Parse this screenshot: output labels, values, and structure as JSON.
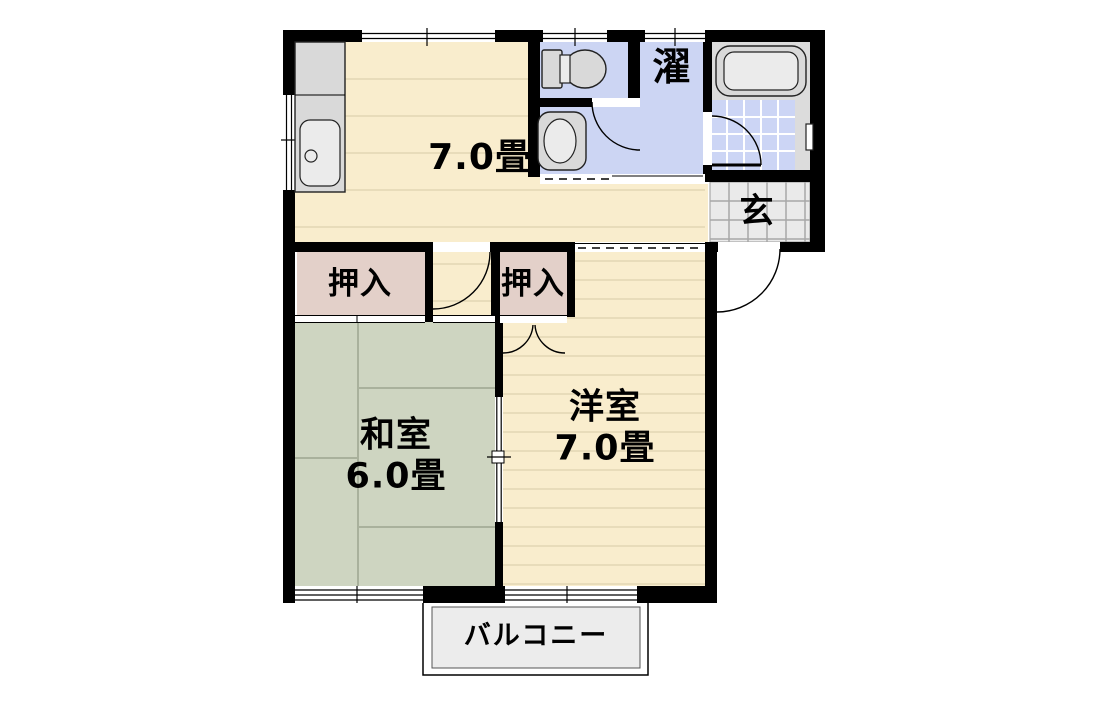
{
  "plan": {
    "rooms": {
      "ldk": {
        "label": "7.0畳"
      },
      "laundry": {
        "label": "濯"
      },
      "genkan": {
        "label": "玄"
      },
      "closet_left": {
        "label": "押入"
      },
      "closet_right": {
        "label": "押入"
      },
      "japanese_room": {
        "name": "和室",
        "size": "6.0畳"
      },
      "western_room": {
        "name": "洋室",
        "size": "7.0畳"
      },
      "balcony": {
        "label": "バルコニー"
      }
    },
    "fixtures": [
      "kitchen-sink",
      "toilet",
      "washbasin",
      "bathtub"
    ],
    "colors": {
      "floor-wood": "#f9edcd",
      "floor-line": "#e8dcba",
      "tatami": "#ced5c1",
      "tatami-line": "#a9b19c",
      "closet": "#e3d0c9",
      "wet-blue": "#ccd5f3",
      "tile-blue": "#ccd5f5",
      "bath-gray": "#dcdcdc",
      "genkan-tile": "#eaeaea",
      "genkan-grid": "#a8a8a8",
      "balcony": "#ececec",
      "fixture": "#d9d9d9",
      "wall": "#000000"
    }
  }
}
